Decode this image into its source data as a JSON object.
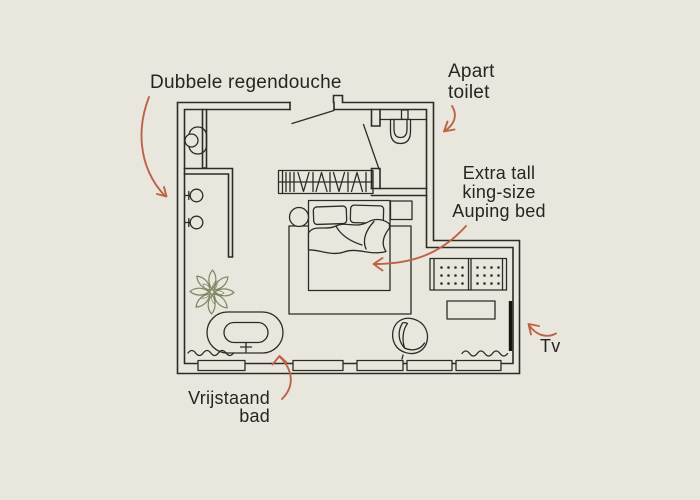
{
  "diagram_title": "Hotel room floor plan with annotated amenities",
  "labels": {
    "shower": {
      "text": "Dubbele regendouche"
    },
    "toilet": {
      "line1": "Apart",
      "line2": "toilet"
    },
    "bed": {
      "line1": "Extra tall",
      "line2": "king-size",
      "line3": "Auping bed"
    },
    "bath": {
      "line1": "Vrijstaand",
      "line2": "bad"
    },
    "tv": {
      "text": "Tv"
    }
  },
  "fixtures": [
    "double-rain-shower-heads",
    "washbasin",
    "separate-toilet",
    "entrance-door",
    "wardrobe-with-hangers",
    "king-size-bed",
    "pillows",
    "duvet",
    "rug",
    "round-stool",
    "nightstand",
    "plant",
    "freestanding-bathtub",
    "bath-mat",
    "armchair",
    "bench-radiator",
    "side-table",
    "wall-mounted-tv",
    "windows"
  ],
  "colors": {
    "bg": "#e9e6de",
    "line": "#2e2b24",
    "text": "#272521",
    "accent": "#bc6347",
    "plant": "#7d8661",
    "dark": "#15140f"
  }
}
